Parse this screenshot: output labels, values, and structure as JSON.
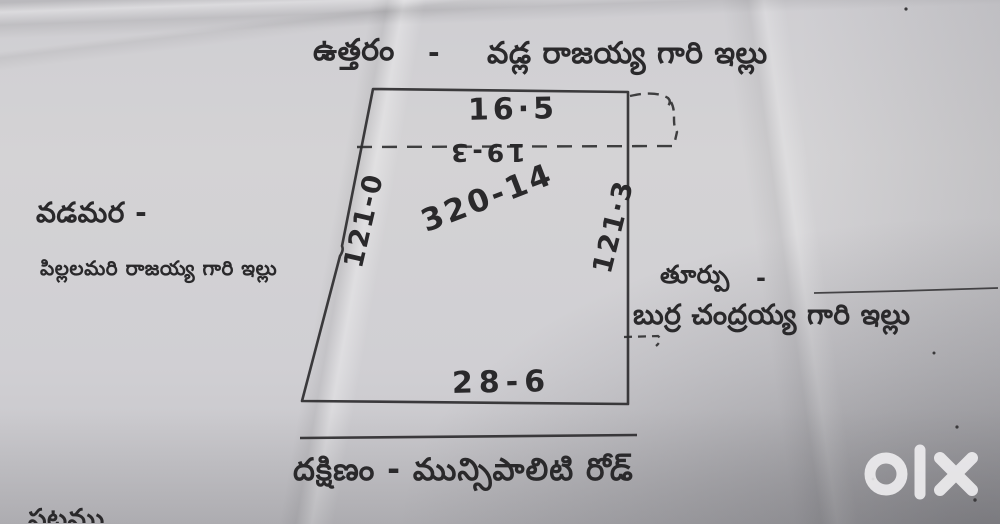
{
  "sketch": {
    "north": {
      "direction": "ఉత్తరం",
      "dash": "-",
      "neighbor": "వడ్ల రాజయ్య గారి ఇల్లు"
    },
    "west": {
      "direction": "వడమర -",
      "neighbor": "పిల్లలమరి రాజయ్య గారి ఇల్లు"
    },
    "east": {
      "direction": "తూర్పు",
      "dash": "-",
      "neighbor": "బుర్ర చంద్రయ్య గారి ఇల్లు"
    },
    "south": {
      "road": "దక్షిణం - మున్సిపాలిటి రోడ్"
    },
    "measurements": {
      "top_width": "16·5",
      "inner_width_inverted": "19-3",
      "area": "320-14",
      "left_side": "121-0",
      "right_side": "121·3",
      "bottom_width": "28-6"
    },
    "partial_bottom_text": "పటము"
  },
  "watermark": {
    "text": "olx"
  },
  "colors": {
    "paper": "#d2d1d3",
    "ink": "#2a292b",
    "watermark": "#f2f1f3"
  }
}
